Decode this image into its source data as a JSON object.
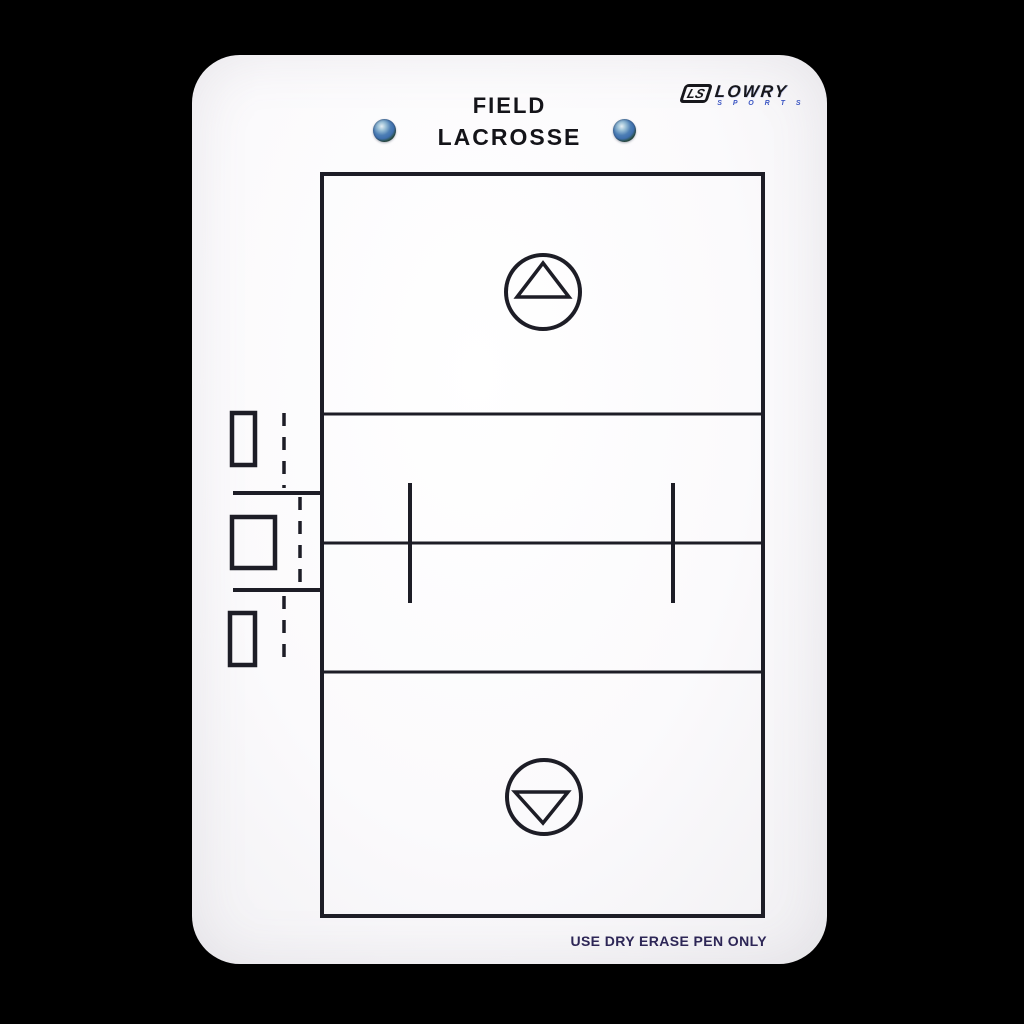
{
  "board": {
    "title_line1": "FIELD",
    "title_line2": "LACROSSE",
    "footer_note": "USE DRY ERASE PEN ONLY"
  },
  "logo": {
    "mark": "LS",
    "name": "LOWRY",
    "subtitle": "S P O R T S"
  },
  "colors": {
    "background": "#000000",
    "board": "#fbfafc",
    "line": "#1d1d26",
    "title_text": "#141419",
    "footer_text": "#2d2656",
    "logo_text": "#17171c",
    "logo_subtitle": "#3b55c3",
    "rivet": "#3f6fae"
  }
}
